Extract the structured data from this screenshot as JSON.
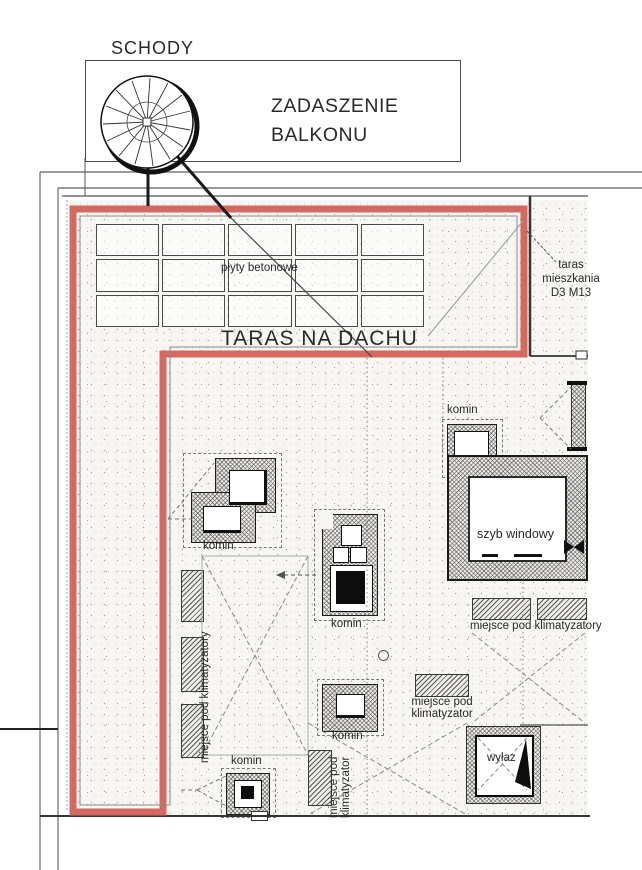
{
  "labels": {
    "schody": "SCHODY",
    "zadaszenie_balkonu": "ZADASZENIE\nBALKONU",
    "plyty_betonowe": "płyty betonowe",
    "taras_na_dachu": "TARAS NA DACHU",
    "taras_mieszkania": "taras\nmieszkania\nD3 M13",
    "komin": "komin",
    "szyb_windowy": "szyb windowy",
    "miejsce_pod_klimatyzatory": "miejsce pod klimatyzatory",
    "miejsce_pod_klimatyzator": "miejsce pod\nklimatyzator",
    "wylaz": "wyłaz"
  },
  "colors": {
    "terrace_outline": "#d4695f",
    "linework": "#333333"
  }
}
